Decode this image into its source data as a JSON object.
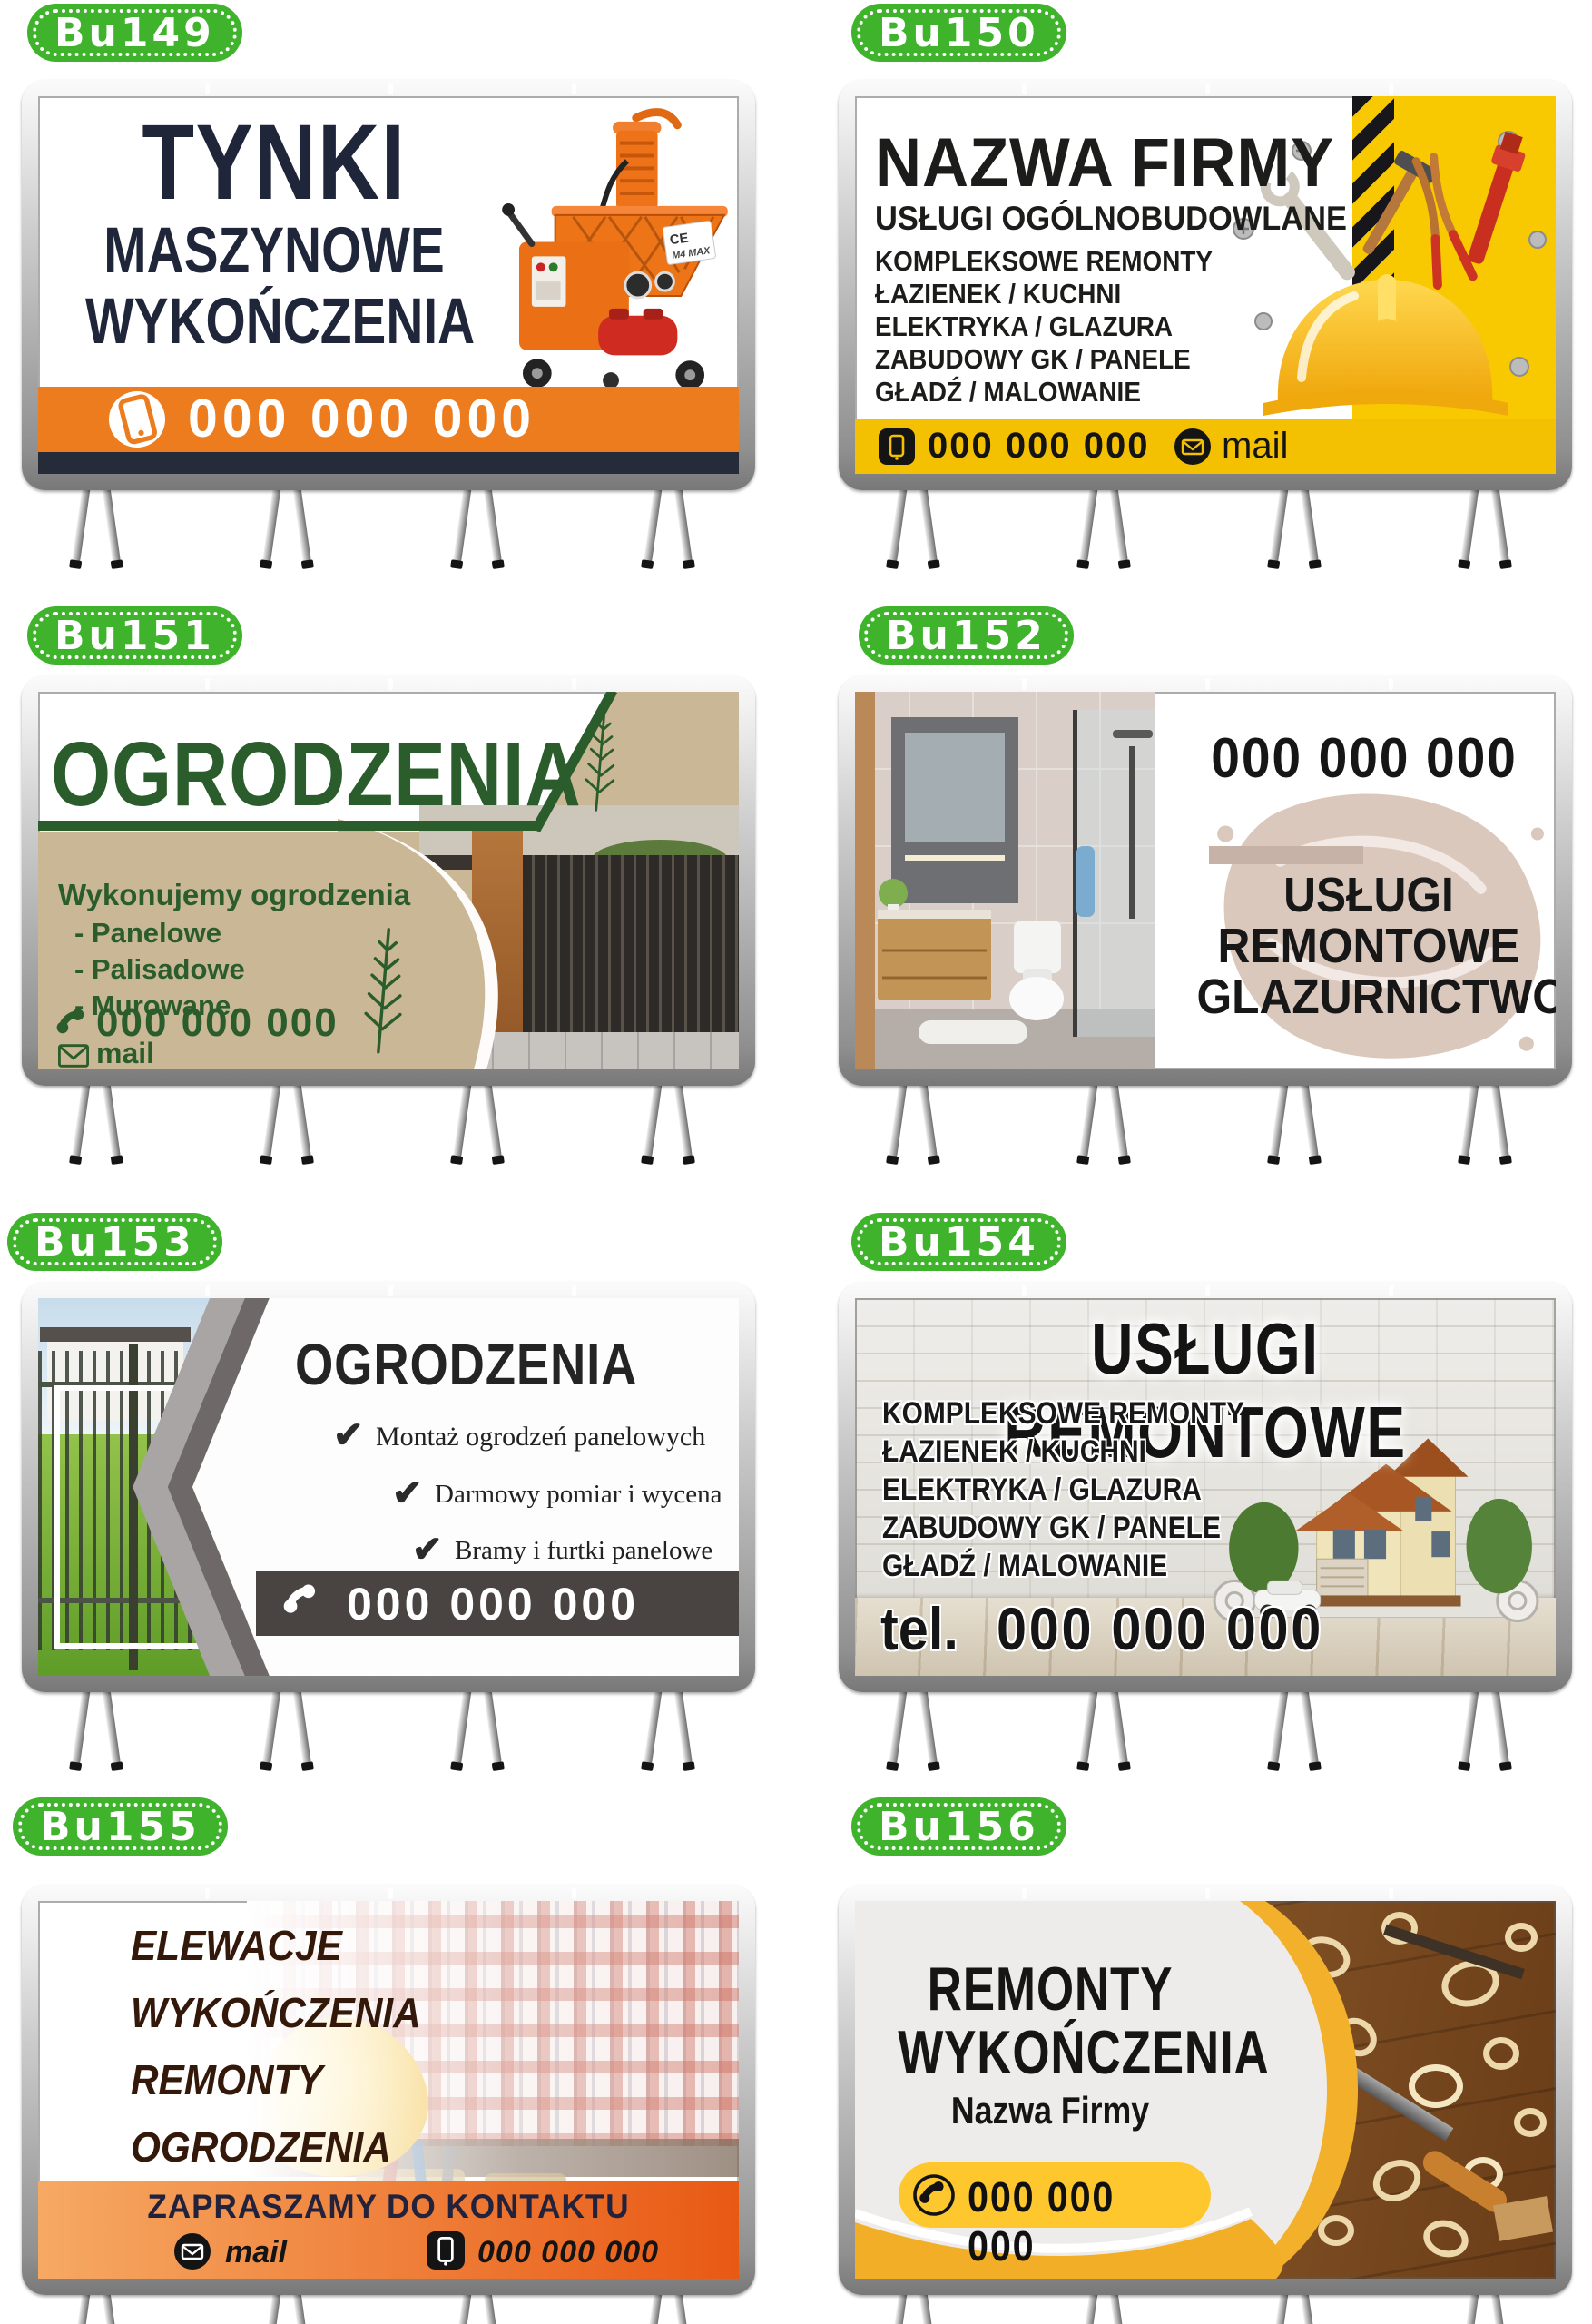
{
  "badges": {
    "bu149": "Bu149",
    "bu150": "Bu150",
    "bu151": "Bu151",
    "bu152": "Bu152",
    "bu153": "Bu153",
    "bu154": "Bu154",
    "bu155": "Bu155",
    "bu156": "Bu156"
  },
  "colors": {
    "badge_green": "#3eb32b",
    "orange": "#ec7c1e",
    "navy": "#262b3a",
    "yellow": "#f8c801",
    "forest_green": "#2a5c2c",
    "beige": "#c9b795",
    "dark_gray_bar": "#494341",
    "orange_gradient_start": "#f6a963",
    "orange_gradient_end": "#e85914",
    "swoosh_yellow": "#f3b02a"
  },
  "bu149": {
    "title_lines": [
      "TYNKI",
      "MASZYNOWE",
      "WYKOŃCZENIA"
    ],
    "phone": "000 000 000",
    "machine_ce": "CE",
    "machine_brand": "M4 MAX"
  },
  "bu150": {
    "company": "NAZWA FIRMY",
    "subtitle": "USŁUGI OGÓLNOBUDOWLANE",
    "services": [
      "KOMPLEKSOWE REMONTY",
      "ŁAZIENEK / KUCHNI",
      "ELEKTRYKA / GLAZURA",
      "ZABUDOWY GK / PANELE",
      "GŁADŹ / MALOWANIE"
    ],
    "phone": "000 000 000",
    "mail": "mail"
  },
  "bu151": {
    "title": "OGRODZENIA",
    "heading": "Wykonujemy ogrodzenia",
    "items": [
      "- Panelowe",
      "- Palisadowe",
      "- Murowane"
    ],
    "phone": "000 000 000",
    "mail": "mail"
  },
  "bu152": {
    "phone": "000 000 000",
    "title_lines": [
      "USŁUGI",
      "REMONTOWE",
      "GLAZURNICTWO"
    ]
  },
  "bu153": {
    "title": "OGRODZENIA",
    "items": [
      "Montaż ogrodzeń panelowych",
      "Darmowy pomiar i wycena",
      "Bramy i furtki panelowe"
    ],
    "phone": "000 000 000"
  },
  "bu154": {
    "title": "USŁUGI REMONTOWE",
    "services": [
      "KOMPLEKSOWE REMONTY",
      "ŁAZIENEK / KUCHNI",
      "ELEKTRYKA / GLAZURA",
      "ZABUDOWY GK / PANELE",
      "GŁADŹ / MALOWANIE"
    ],
    "phone_prefix": "tel.",
    "phone": "000 000 000"
  },
  "bu155": {
    "items": [
      "ELEWACJE",
      "WYKOŃCZENIA",
      "REMONTY",
      "OGRODZENIA"
    ],
    "cta": "ZAPRASZAMY DO KONTAKTU",
    "mail": "mail",
    "phone": "000 000 000"
  },
  "bu156": {
    "title_lines": [
      "REMONTY",
      "WYKOŃCZENIA"
    ],
    "company": "Nazwa Firmy",
    "phone": "000 000 000"
  }
}
